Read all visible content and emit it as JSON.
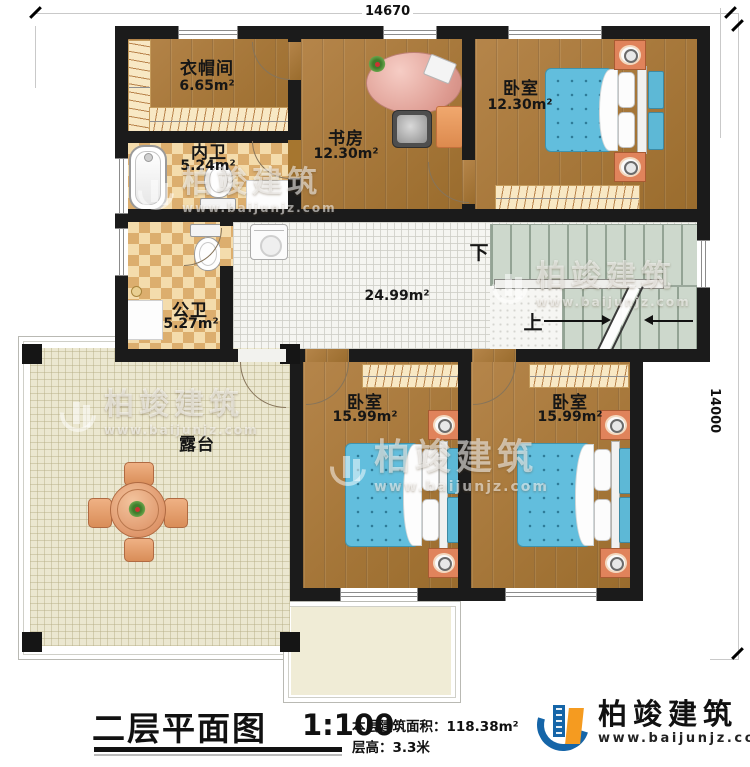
{
  "dimensions": {
    "top": "14670",
    "right": "14000"
  },
  "rooms": {
    "cloakroom": {
      "name": "衣帽间",
      "area": "6.65m²"
    },
    "study": {
      "name": "书房",
      "area": "12.30m²"
    },
    "bedroom_top": {
      "name": "卧室",
      "area": "12.30m²"
    },
    "inner_bath": {
      "name": "内卫",
      "area": "5.24m²"
    },
    "public_bath": {
      "name": "公卫",
      "area": "5.27m²"
    },
    "hallway": {
      "area": "24.99m²"
    },
    "terrace": {
      "name": "露台"
    },
    "bedroom_left": {
      "name": "卧室",
      "area": "15.99m²"
    },
    "bedroom_right": {
      "name": "卧室",
      "area": "15.99m²"
    }
  },
  "stairs": {
    "down_label": "下",
    "up_label": "上"
  },
  "title_block": {
    "title": "二层平面图",
    "scale": "1:100",
    "area_line": "本层建筑面积：118.38m²",
    "floor_height_line": "层高：3.3米"
  },
  "brand": {
    "name": "柏竣建筑",
    "website": "www.baijunjz.com"
  },
  "watermark": {
    "name": "柏竣建筑",
    "website": "www.baijunjz.com"
  },
  "colors": {
    "wall": "#1b1b1b",
    "wood_floor": "#a6762f",
    "bath_tile_light": "#f4dcac",
    "bath_tile_dark": "#dcae6e",
    "hall_tile": "#f5f5f1",
    "terrace_tile": "#ebe7d0",
    "stair": "#cdd8cc",
    "bed_blue": "#62bedd",
    "nightstand_orange": "#e0835b",
    "logo_blue": "#1565a8",
    "logo_orange": "#f59b20"
  }
}
